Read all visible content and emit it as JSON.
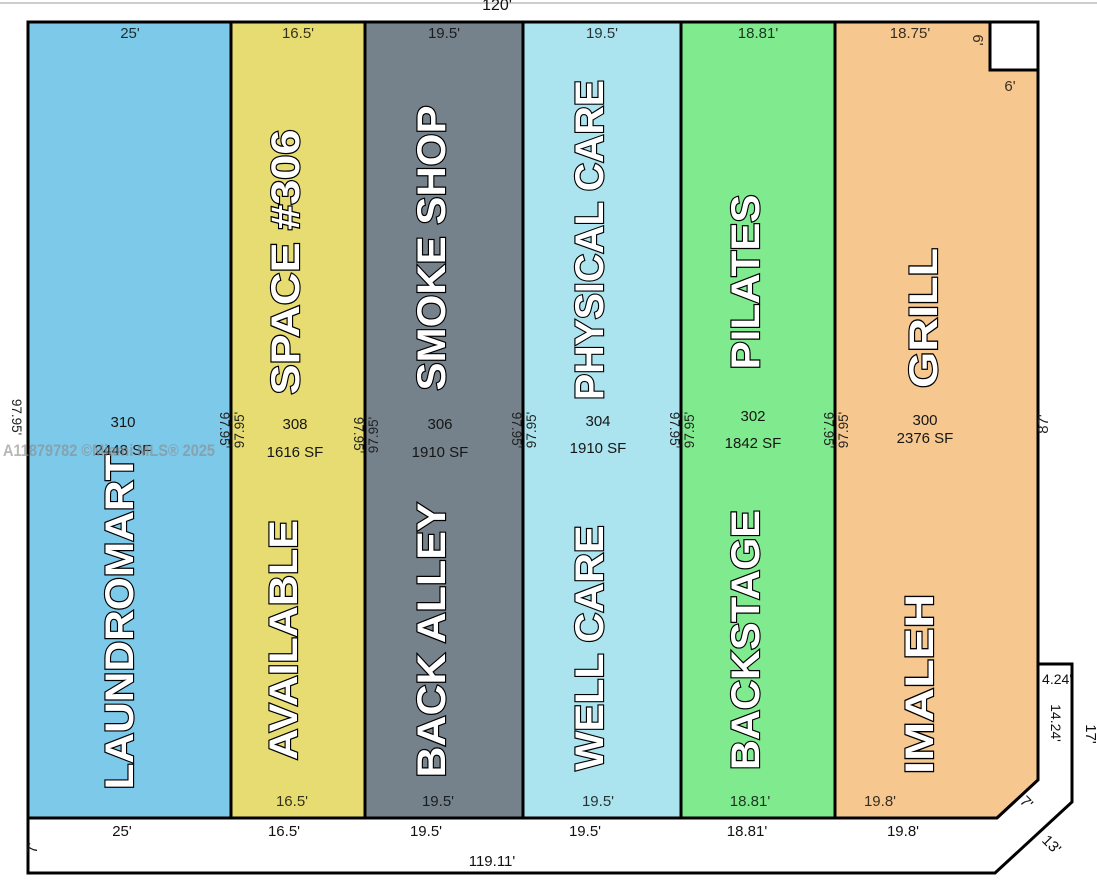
{
  "watermark": "A11879782 ©Miami MLS® 2025",
  "suites": [
    {
      "number": "310",
      "area": "2448 SF",
      "name_top": "",
      "name_bottom": "LAUNDROMART",
      "width_top": "25'",
      "width_bottom_inner": "",
      "width_bottom": "25'",
      "color": "#7dc9e9"
    },
    {
      "number": "308",
      "area": "1616 SF",
      "name_top": "SPACE #306",
      "name_bottom": "AVAILABLE",
      "width_top": "16.5'",
      "width_bottom_inner": "16.5'",
      "width_bottom": "16.5'",
      "color": "#e7dc72"
    },
    {
      "number": "306",
      "area": "1910 SF",
      "name_top": "SMOKE SHOP",
      "name_bottom": "BACK ALLEY",
      "width_top": "19.5'",
      "width_bottom_inner": "19.5'",
      "width_bottom": "19.5'",
      "color": "#76828b"
    },
    {
      "number": "304",
      "area": "1910 SF",
      "name_top": "PHYSICAL CARE",
      "name_bottom": "WELL CARE",
      "width_top": "19.5'",
      "width_bottom_inner": "19.5'",
      "width_bottom": "19.5'",
      "color": "#abe4ef"
    },
    {
      "number": "302",
      "area": "1842 SF",
      "name_top": "PILATES",
      "name_bottom": "BACKSTAGE",
      "width_top": "18.81'",
      "width_bottom_inner": "18.81'",
      "width_bottom": "18.81'",
      "color": "#80eb8e"
    },
    {
      "number": "300",
      "area": "2376 SF",
      "name_top": "GRILL",
      "name_bottom": "IMALEH",
      "width_top": "18.75'",
      "width_bottom_inner": "19.8'",
      "width_bottom": "19.8'",
      "color": "#f6c890"
    }
  ],
  "boundary": {
    "top_total": "120'",
    "bottom_total": "119.11'",
    "right_side": "87'",
    "suite_depth": "97.95'",
    "notch_width": "6'",
    "notch_height": "6'",
    "left_margin": "7'",
    "suite_corner_cut": "7'",
    "parcel_corner_cut": "13'",
    "jut_top": "4.24'",
    "jut_side": "14.24'",
    "jut_right": "17'"
  }
}
